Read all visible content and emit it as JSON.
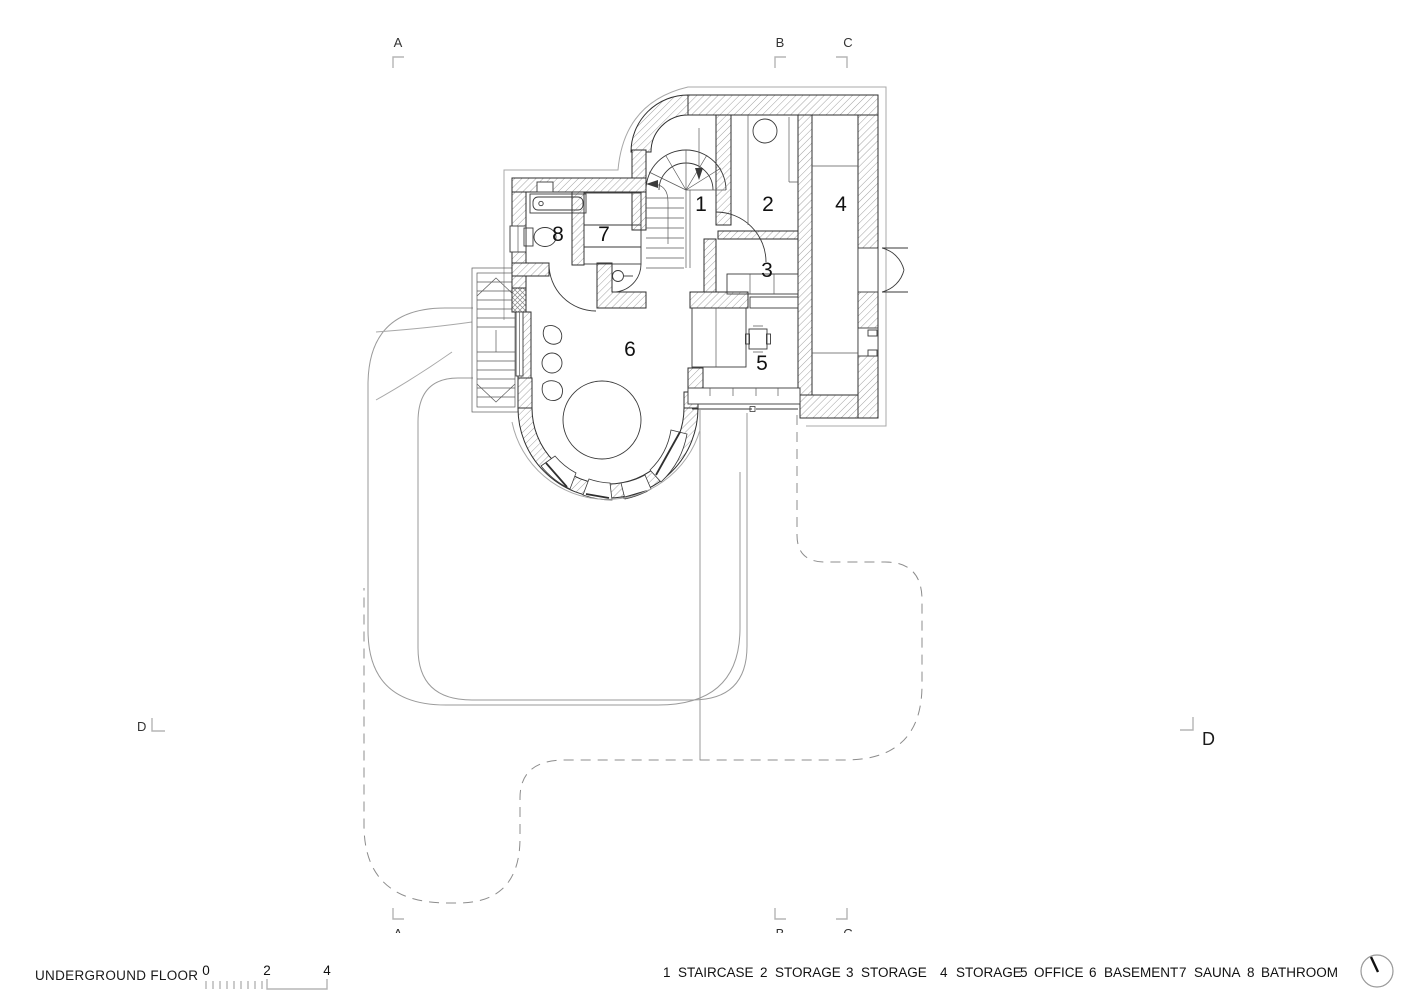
{
  "title": "UNDERGROUND FLOOR",
  "drawing_type": "architectural floor plan",
  "rooms": {
    "r1": "1",
    "r2": "2",
    "r3": "3",
    "r4": "4",
    "r5": "5",
    "r6": "6",
    "r7": "7",
    "r8": "8"
  },
  "legend": [
    {
      "num": "1",
      "label": "STAIRCASE"
    },
    {
      "num": "2",
      "label": "STORAGE"
    },
    {
      "num": "3",
      "label": "STORAGE"
    },
    {
      "num": "4",
      "label": "STORAGE"
    },
    {
      "num": "5",
      "label": "OFFICE"
    },
    {
      "num": "6",
      "label": "BASEMENT"
    },
    {
      "num": "7",
      "label": "SAUNA"
    },
    {
      "num": "8",
      "label": "BATHROOM"
    }
  ],
  "scale": {
    "t0": "0",
    "t2": "2",
    "t4": "4"
  },
  "markers": {
    "top_a": "A",
    "top_b": "B",
    "top_c": "C",
    "bottom_a": "A",
    "bottom_b": "B",
    "bottom_c": "C",
    "left_d": "D",
    "right_d": "D"
  },
  "colors": {
    "wall_line": "#2f2f2f",
    "hatch": "#8a8a8a",
    "terrain_line": "#9a9a9a",
    "dashed_line": "#8c8c8c",
    "bracket": "#b5b5b5",
    "text": "#1a1a1a"
  }
}
